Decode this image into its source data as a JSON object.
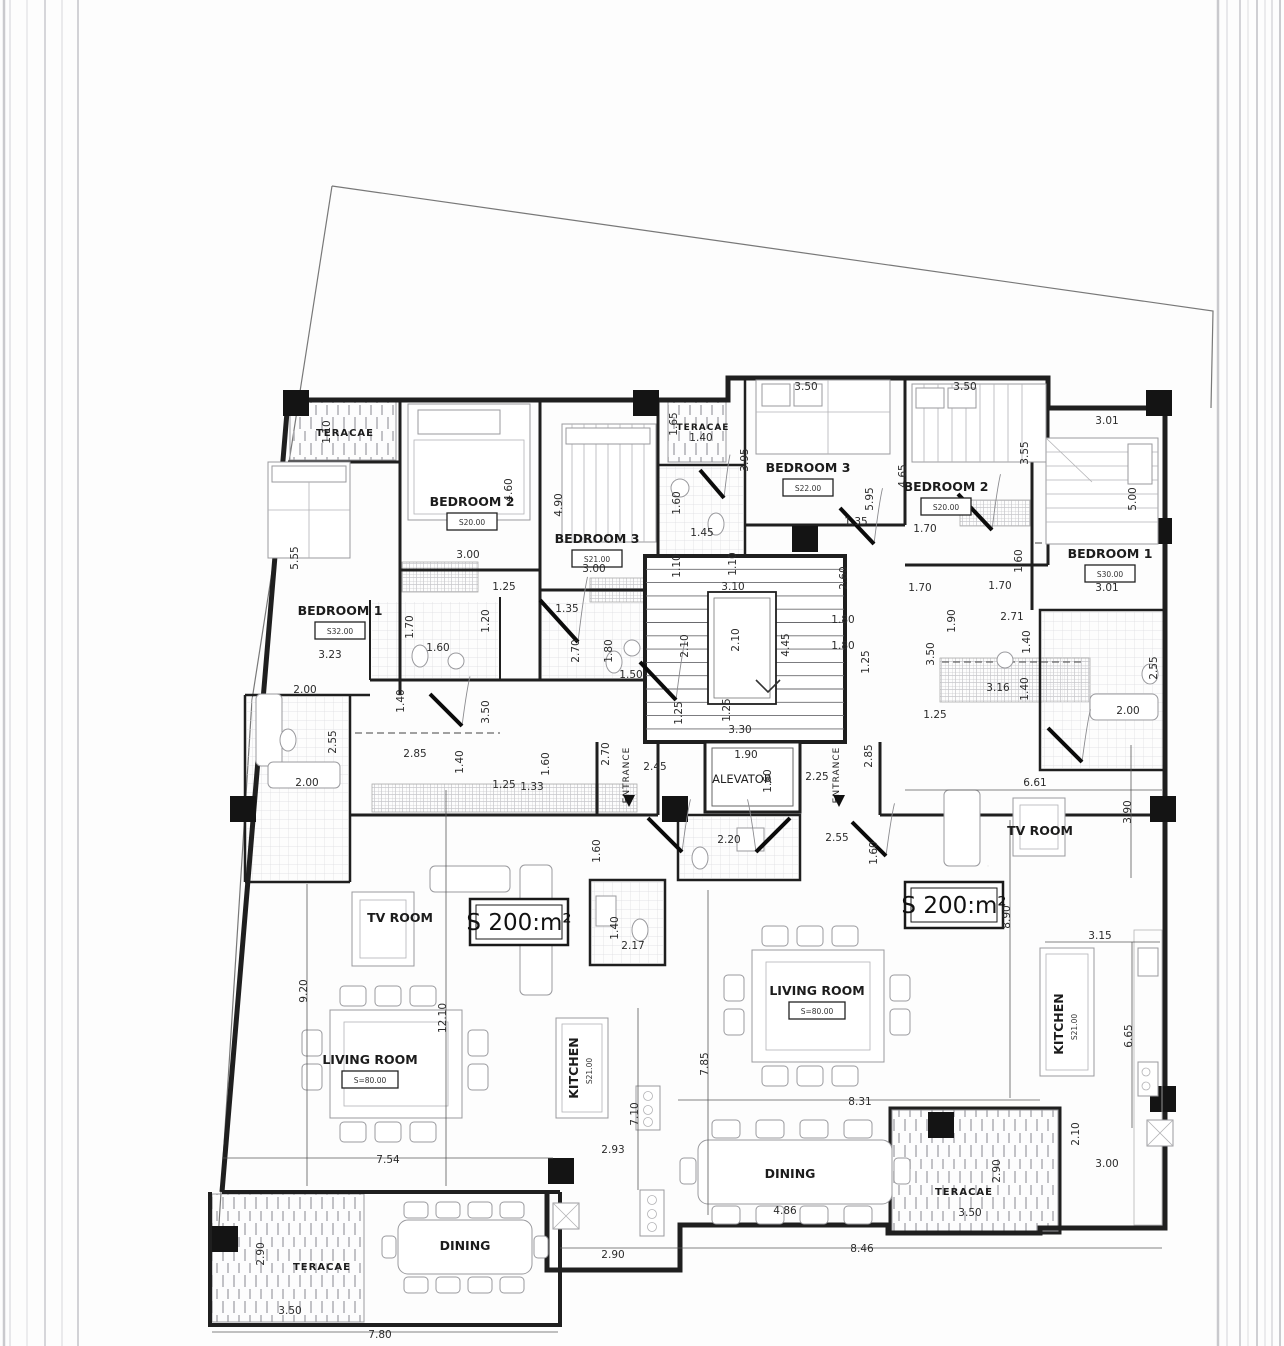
{
  "units": {
    "left_area": "S 200:m²",
    "right_area": "S 200:m²"
  },
  "core": {
    "elevator": "ALEVATOR",
    "entrance": "ENTRANCE"
  },
  "rooms": [
    {
      "label": "TERACAE",
      "x": 345,
      "y": 436,
      "fs": 10
    },
    {
      "label": "BEDROOM 2",
      "area": "S20.00",
      "x": 472,
      "y": 506
    },
    {
      "label": "BEDROOM 3",
      "area": "S21.00",
      "x": 597,
      "y": 543
    },
    {
      "label": "BEDROOM 1",
      "area": "S32.00",
      "x": 340,
      "y": 615
    },
    {
      "label": "TV ROOM",
      "x": 400,
      "y": 922
    },
    {
      "label": "LIVING ROOM",
      "area": "S=80.00",
      "x": 370,
      "y": 1064
    },
    {
      "label": "KITCHEN",
      "area": "S21.00",
      "x": 578,
      "y": 1068,
      "rot": 1
    },
    {
      "label": "DINING",
      "x": 465,
      "y": 1250
    },
    {
      "label": "TERACAE",
      "x": 322,
      "y": 1270,
      "fs": 10
    },
    {
      "label": "TERACAE",
      "x": 703,
      "y": 430,
      "fs": 9
    },
    {
      "label": "BEDROOM 3",
      "area": "S22.00",
      "x": 808,
      "y": 472
    },
    {
      "label": "BEDROOM 2",
      "area": "S20.00",
      "x": 946,
      "y": 491
    },
    {
      "label": "BEDROOM 1",
      "area": "S30.00",
      "x": 1110,
      "y": 558
    },
    {
      "label": "TV ROOM",
      "x": 1040,
      "y": 835
    },
    {
      "label": "LIVING ROOM",
      "area": "S=80.00",
      "x": 817,
      "y": 995
    },
    {
      "label": "KITCHEN",
      "area": "S21.00",
      "x": 1063,
      "y": 1024,
      "rot": 1
    },
    {
      "label": "DINING",
      "x": 790,
      "y": 1178
    },
    {
      "label": "TERACAE",
      "x": 964,
      "y": 1195,
      "fs": 10
    }
  ],
  "dimensions": [
    {
      "v": "1.10",
      "x": 330,
      "y": 432,
      "r": 1
    },
    {
      "v": "5.55",
      "x": 298,
      "y": 558,
      "r": 1
    },
    {
      "v": "3.23",
      "x": 330,
      "y": 658
    },
    {
      "v": "4.60",
      "x": 512,
      "y": 490,
      "r": 1
    },
    {
      "v": "3.00",
      "x": 468,
      "y": 558
    },
    {
      "v": "4.90",
      "x": 562,
      "y": 505,
      "r": 1
    },
    {
      "v": "3.00",
      "x": 594,
      "y": 572
    },
    {
      "v": "1.25",
      "x": 504,
      "y": 590
    },
    {
      "v": "1.20",
      "x": 489,
      "y": 621,
      "r": 1
    },
    {
      "v": "1.70",
      "x": 413,
      "y": 627,
      "r": 1
    },
    {
      "v": "1.60",
      "x": 438,
      "y": 651
    },
    {
      "v": "1.35",
      "x": 567,
      "y": 612
    },
    {
      "v": "2.70",
      "x": 579,
      "y": 651,
      "r": 1
    },
    {
      "v": "1.80",
      "x": 612,
      "y": 651,
      "r": 1
    },
    {
      "v": "1.50",
      "x": 631,
      "y": 678
    },
    {
      "v": "1.40",
      "x": 404,
      "y": 701,
      "r": 1
    },
    {
      "v": "2.00",
      "x": 305,
      "y": 693
    },
    {
      "v": "2.55",
      "x": 336,
      "y": 742,
      "r": 1
    },
    {
      "v": "2.00",
      "x": 307,
      "y": 786
    },
    {
      "v": "2.85",
      "x": 415,
      "y": 757
    },
    {
      "v": "1.40",
      "x": 463,
      "y": 762,
      "r": 1
    },
    {
      "v": "3.50",
      "x": 489,
      "y": 712,
      "r": 1
    },
    {
      "v": "1.25",
      "x": 504,
      "y": 788
    },
    {
      "v": "1.33",
      "x": 532,
      "y": 790
    },
    {
      "v": "1.60",
      "x": 549,
      "y": 764,
      "r": 1
    },
    {
      "v": "1.10",
      "x": 680,
      "y": 566,
      "r": 1
    },
    {
      "v": "1.10",
      "x": 736,
      "y": 564,
      "r": 1
    },
    {
      "v": "3.10",
      "x": 733,
      "y": 590
    },
    {
      "v": "2.10",
      "x": 688,
      "y": 646,
      "r": 1
    },
    {
      "v": "2.10",
      "x": 739,
      "y": 640,
      "r": 1
    },
    {
      "v": "4.45",
      "x": 789,
      "y": 645,
      "r": 1
    },
    {
      "v": "2.60",
      "x": 847,
      "y": 578,
      "r": 1
    },
    {
      "v": "1.80",
      "x": 843,
      "y": 623
    },
    {
      "v": "1.80",
      "x": 843,
      "y": 649
    },
    {
      "v": "1.25",
      "x": 869,
      "y": 662,
      "r": 1
    },
    {
      "v": "1.25",
      "x": 682,
      "y": 713,
      "r": 1
    },
    {
      "v": "1.25",
      "x": 730,
      "y": 710,
      "r": 1
    },
    {
      "v": "3.30",
      "x": 740,
      "y": 733
    },
    {
      "v": "2.70",
      "x": 609,
      "y": 754,
      "r": 1
    },
    {
      "v": "2.45",
      "x": 655,
      "y": 770
    },
    {
      "v": "1.90",
      "x": 746,
      "y": 758
    },
    {
      "v": "1.60",
      "x": 771,
      "y": 781,
      "r": 1
    },
    {
      "v": "2.25",
      "x": 817,
      "y": 780
    },
    {
      "v": "2.85",
      "x": 872,
      "y": 756,
      "r": 1
    },
    {
      "v": "2.20",
      "x": 729,
      "y": 843
    },
    {
      "v": "2.55",
      "x": 837,
      "y": 841
    },
    {
      "v": "1.60",
      "x": 600,
      "y": 851,
      "r": 1
    },
    {
      "v": "1.60",
      "x": 877,
      "y": 853,
      "r": 1
    },
    {
      "v": "1.40",
      "x": 618,
      "y": 928,
      "r": 1
    },
    {
      "v": "2.17",
      "x": 633,
      "y": 949
    },
    {
      "v": "1.65",
      "x": 677,
      "y": 424,
      "r": 1
    },
    {
      "v": "1.40",
      "x": 701,
      "y": 441
    },
    {
      "v": "1.60",
      "x": 680,
      "y": 503,
      "r": 1
    },
    {
      "v": "1.45",
      "x": 702,
      "y": 536
    },
    {
      "v": "3.50",
      "x": 806,
      "y": 390
    },
    {
      "v": "3.95",
      "x": 748,
      "y": 460,
      "r": 1
    },
    {
      "v": "5.95",
      "x": 873,
      "y": 499,
      "r": 1
    },
    {
      "v": "1.35",
      "x": 856,
      "y": 525
    },
    {
      "v": "3.50",
      "x": 965,
      "y": 390
    },
    {
      "v": "4.65",
      "x": 906,
      "y": 476,
      "r": 1
    },
    {
      "v": "3.55",
      "x": 1028,
      "y": 453,
      "r": 1
    },
    {
      "v": "1.70",
      "x": 925,
      "y": 532
    },
    {
      "v": "1.70",
      "x": 1000,
      "y": 589
    },
    {
      "v": "1.70",
      "x": 920,
      "y": 591
    },
    {
      "v": "1.90",
      "x": 955,
      "y": 621,
      "r": 1
    },
    {
      "v": "2.71",
      "x": 1012,
      "y": 620
    },
    {
      "v": "1.40",
      "x": 1030,
      "y": 642,
      "r": 1
    },
    {
      "v": "3.50",
      "x": 934,
      "y": 654,
      "r": 1
    },
    {
      "v": "3.16",
      "x": 998,
      "y": 691
    },
    {
      "v": "1.40",
      "x": 1028,
      "y": 689,
      "r": 1
    },
    {
      "v": "1.25",
      "x": 935,
      "y": 718
    },
    {
      "v": "2.55",
      "x": 1157,
      "y": 668,
      "r": 1
    },
    {
      "v": "2.00",
      "x": 1128,
      "y": 714
    },
    {
      "v": "3.01",
      "x": 1107,
      "y": 424
    },
    {
      "v": "5.00",
      "x": 1136,
      "y": 499,
      "r": 1
    },
    {
      "v": "3.01",
      "x": 1107,
      "y": 591
    },
    {
      "v": "1.60",
      "x": 1022,
      "y": 561,
      "r": 1
    },
    {
      "v": "6.61",
      "x": 1035,
      "y": 786
    },
    {
      "v": "3.90",
      "x": 1131,
      "y": 812,
      "r": 1
    },
    {
      "v": "8.90",
      "x": 1010,
      "y": 917,
      "r": 1
    },
    {
      "v": "3.15",
      "x": 1100,
      "y": 939
    },
    {
      "v": "6.65",
      "x": 1132,
      "y": 1036,
      "r": 1
    },
    {
      "v": "7.85",
      "x": 708,
      "y": 1064,
      "r": 1
    },
    {
      "v": "8.31",
      "x": 860,
      "y": 1105
    },
    {
      "v": "4.86",
      "x": 785,
      "y": 1214
    },
    {
      "v": "2.90",
      "x": 1000,
      "y": 1171,
      "r": 1
    },
    {
      "v": "3.50",
      "x": 970,
      "y": 1216
    },
    {
      "v": "8.46",
      "x": 862,
      "y": 1252
    },
    {
      "v": "2.10",
      "x": 1079,
      "y": 1134,
      "r": 1
    },
    {
      "v": "3.00",
      "x": 1107,
      "y": 1167
    },
    {
      "v": "9.20",
      "x": 307,
      "y": 991,
      "r": 1
    },
    {
      "v": "12.10",
      "x": 446,
      "y": 1018,
      "r": 1
    },
    {
      "v": "7.54",
      "x": 388,
      "y": 1163
    },
    {
      "v": "7.10",
      "x": 638,
      "y": 1114,
      "r": 1
    },
    {
      "v": "2.93",
      "x": 613,
      "y": 1153
    },
    {
      "v": "2.90",
      "x": 264,
      "y": 1254,
      "r": 1
    },
    {
      "v": "3.50",
      "x": 290,
      "y": 1314
    },
    {
      "v": "7.80",
      "x": 380,
      "y": 1338
    },
    {
      "v": "2.90",
      "x": 613,
      "y": 1258
    }
  ]
}
